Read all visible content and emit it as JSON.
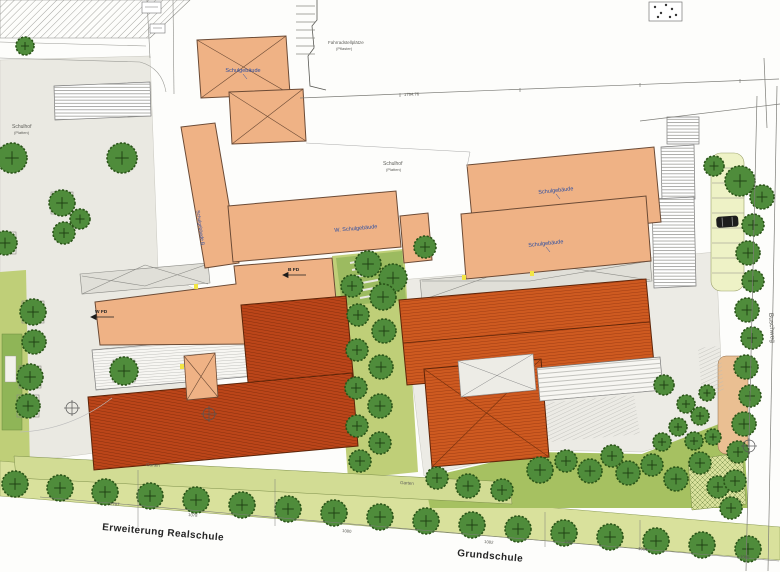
{
  "plan_type": "architectural site plan (Lageplan) of a school campus",
  "labels": {
    "schulhof_left_1": "Schulhof",
    "schulhof_left_2": "(Platten)",
    "schulhof_center_1": "Schulhof",
    "schulhof_center_2": "(Platten)",
    "fahrrad_1": "Fahrradstellplätze",
    "fahrrad_2": "(Pflaster)",
    "building_a": "Schulgebäude",
    "building_b": "Schulgebäude B",
    "building_w": "W. Schulgebäude",
    "building_c": "Schulgebäude",
    "building_d": "Schulgebäude",
    "b_fd": "B FD",
    "w_fd": "W FD",
    "garten_left": "Garten",
    "garten_right": "Garten",
    "erweiterung": "Erweiterung Realschule",
    "grundschule": "Grundschule",
    "buschweg": "Buschweg"
  },
  "dimensions": {
    "north": "1794.76",
    "d2787": "2787",
    "d1078": "1078",
    "d1080": "1080",
    "d1082": "1082",
    "d1087": "1087",
    "d1084": "1084",
    "d1088": "1088"
  },
  "colors": {
    "building_salmon": "#EFB285",
    "roof_red": "#CE5A20",
    "roof_dark_red": "#BB4519",
    "tree_green": "#4F8C3B",
    "lawn_light": "#D9E19C",
    "lawn_olive": "#A6C161",
    "parking_strip": "#EEF2C6",
    "pavement": "#EAE9E2",
    "label_blue": "#2B4EA2",
    "marker_yellow": "#F2E545"
  }
}
